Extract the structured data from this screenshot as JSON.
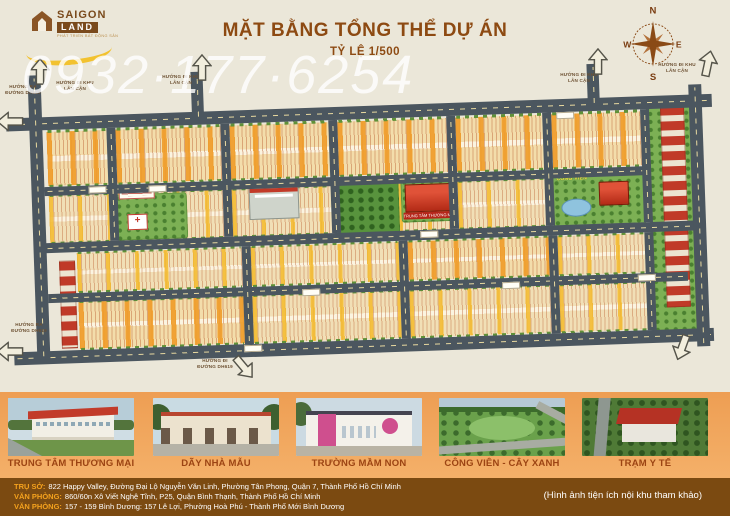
{
  "watermark": "0932·177·6254",
  "header": {
    "logo": {
      "name_line1": "SAIGON",
      "name_line2": "LAND",
      "tagline": "PHÁT TRIỂN BẤT ĐỘNG SẢN"
    },
    "title": "MẶT BẰNG TỔNG THỂ DỰ ÁN",
    "scale": "TỶ LỆ 1/500",
    "compass": {
      "north": "N",
      "east": "E",
      "south": "S",
      "west": "W"
    }
  },
  "map": {
    "direction_labels": {
      "out_dh619": "HƯỚNG RA ĐƯỜNG DH619",
      "to_neighbor": "HƯỚNG ĐI KHU LÂN CẬN",
      "to_dh619": "HƯỚNG ĐI ĐƯỜNG DH619"
    },
    "poi_labels": {
      "park": "CÔNG VIÊN",
      "commercial_center": "TRUNG TÂM THƯƠNG MẠI"
    }
  },
  "gallery": {
    "items": [
      {
        "caption": "TRUNG TÂM THƯƠNG MẠI"
      },
      {
        "caption": "DÃY NHÀ MẪU"
      },
      {
        "caption": "TRƯỜNG MẦM NON"
      },
      {
        "caption": "CÔNG VIÊN - CÂY XANH"
      },
      {
        "caption": "TRẠM Y TẾ"
      }
    ]
  },
  "footer": {
    "lines": [
      {
        "label": "TRỤ SỞ:",
        "text": "822 Happy Valley, Đường Đại Lộ Nguyễn Văn Linh, Phường Tân Phong, Quận 7, Thành Phố Hồ Chí Minh"
      },
      {
        "label": "VĂN PHÒNG:",
        "text": "860/60n Xô Viết Nghệ Tĩnh, P25, Quận Bình Thạnh, Thành Phố Hồ Chí Minh"
      },
      {
        "label": "VĂN PHÒNG:",
        "text": "157 - 159 Bình Dương: 157 Lê Lợi, Phường Hoà Phú - Thành Phố Mới Bình Dương"
      }
    ],
    "note": "(Hình ảnh tiện ích nội khu tham khảo)"
  },
  "colors": {
    "title_brown": "#8d4a12",
    "strip_orange": "#efa055",
    "footer_brown": "#7b4a11",
    "accent_yellow": "#f2c230",
    "road_gray": "#4b565f",
    "plot_yellow": "#f6c53e",
    "park_green": "#7cb054",
    "building_red": "#b5271a"
  }
}
